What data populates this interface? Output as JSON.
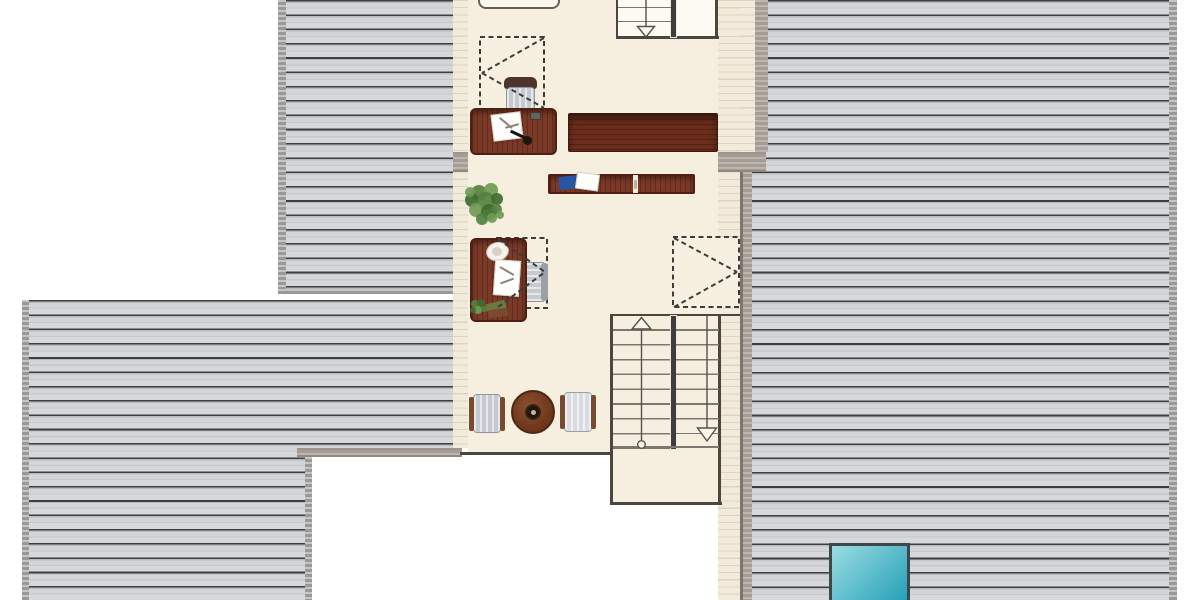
{
  "meta": {
    "type": "architectural-floor-plan-attic-level",
    "visible_text": "none"
  },
  "canvas": {
    "w": 1200,
    "h": 600,
    "bg": "#ffffff"
  },
  "palette": {
    "roof_line": "#3e3e3e",
    "roof_base": "#d3d5d6",
    "roof_edge": "#a6a6a6",
    "eave_base": "#f2ebdb",
    "eave_line": "#ddd3bf",
    "wall": "#aea69e",
    "outline": "#4c463f",
    "stair_line": "#7d786f",
    "floor": "#f6eede",
    "wood_desk": "#7b3927",
    "wood_sideboard": "#6b2d1c",
    "chair_gray": "#c6cad0",
    "chair_back_brown": "#4e342a",
    "armrest_brown": "#7a4a30",
    "table_wood": "#8c5130",
    "plant_green": "#55813f",
    "notebook_blue": "#2a55a4",
    "skylight_glass_light": "#9adde2",
    "skylight_glass_dark": "#27a0b8",
    "skylight_frame": "#3d484c"
  },
  "areas": [
    {
      "name": "roof-top-left",
      "cls": "roof",
      "r": [
        278,
        0,
        175,
        293
      ]
    },
    {
      "name": "roof-top-left-edge-left",
      "cls": "roof-edge",
      "r": [
        278,
        0,
        8,
        293
      ]
    },
    {
      "name": "roof-top-left-edge-bottom",
      "cls": "roof-edge",
      "r": [
        278,
        288.5,
        175,
        5
      ]
    },
    {
      "name": "roof-bottom-left",
      "cls": "roof",
      "r": [
        22,
        300,
        431,
        300
      ]
    },
    {
      "name": "roof-bottom-left-edge-left",
      "cls": "roof-edge",
      "r": [
        22,
        300,
        7,
        300
      ]
    },
    {
      "name": "void-bottom-left",
      "cls": "white",
      "r": [
        312,
        457,
        141,
        143
      ]
    },
    {
      "name": "roof-bottom-left-edge-right",
      "cls": "roof-edge",
      "r": [
        305,
        457,
        7,
        143
      ]
    },
    {
      "name": "roof-right",
      "cls": "roof",
      "r": [
        752,
        0,
        417,
        600
      ]
    },
    {
      "name": "roof-right-edge-right",
      "cls": "roof-edge",
      "r": [
        1169,
        0,
        8,
        600
      ]
    },
    {
      "name": "eave-strip-left",
      "cls": "eave",
      "r": [
        453,
        0,
        15,
        448
      ]
    },
    {
      "name": "eave-strip-left-top",
      "cls": "eave",
      "r": [
        453,
        0,
        30,
        37
      ]
    },
    {
      "name": "eave-strip-right",
      "cls": "eave",
      "r": [
        718,
        0,
        22,
        600
      ]
    },
    {
      "name": "eave-strip-right-upper",
      "cls": "eave",
      "r": [
        740,
        0,
        15,
        152
      ]
    },
    {
      "name": "wall-upper-right",
      "cls": "wall",
      "r": [
        755,
        0,
        13,
        152
      ]
    },
    {
      "name": "wall-right",
      "cls": "wall wall-left-edge",
      "r": [
        740,
        172,
        12,
        428
      ]
    },
    {
      "name": "wall-mid-horizontal",
      "cls": "wall wall-h",
      "r": [
        453,
        152,
        313,
        20
      ]
    },
    {
      "name": "wall-bottom-horizontal",
      "cls": "wall wall-h",
      "r": [
        297,
        448,
        165,
        9
      ]
    },
    {
      "name": "floor-main-room",
      "cls": "floor",
      "r": [
        468,
        0,
        250,
        453
      ]
    },
    {
      "name": "floor-stairwell-extension",
      "cls": "floor",
      "r": [
        612,
        448,
        108,
        55
      ]
    },
    {
      "name": "floor-upper-stairs",
      "cls": "floor-light",
      "r": [
        617,
        0,
        99,
        38
      ]
    },
    {
      "name": "room-bottom-wall-line",
      "cls": "ln",
      "r": [
        460,
        451.5,
        153,
        3
      ]
    },
    {
      "name": "stairwell-left-wall-line",
      "cls": "ln",
      "r": [
        610,
        313.5,
        3,
        191
      ]
    },
    {
      "name": "stairwell-bottom-wall-line",
      "cls": "ln",
      "r": [
        610,
        501.5,
        112,
        3
      ]
    },
    {
      "name": "stairwell-right-wall-line",
      "cls": "ln",
      "r": [
        718,
        313.5,
        3,
        191
      ]
    },
    {
      "name": "stairwell-top-line",
      "cls": "ln",
      "r": [
        610,
        313.5,
        130,
        2.5
      ]
    },
    {
      "name": "upper-stairs-left-line",
      "cls": "ln",
      "r": [
        615.5,
        0,
        2.5,
        38
      ]
    },
    {
      "name": "upper-stairs-bottom-line",
      "cls": "ln",
      "r": [
        615.5,
        36,
        103,
        3
      ]
    },
    {
      "name": "upper-stairs-right-line",
      "cls": "ln",
      "r": [
        715,
        0,
        3,
        38
      ]
    },
    {
      "name": "upper-stairs-divider",
      "cls": "divider",
      "r": [
        671,
        0,
        5,
        36.5
      ]
    },
    {
      "name": "main-stairs-divider",
      "cls": "divider",
      "r": [
        670.5,
        316,
        5,
        133
      ]
    },
    {
      "name": "main-stairs-treads-left-flight",
      "cls": "treads",
      "r": [
        613,
        316,
        57,
        133
      ]
    },
    {
      "name": "main-stairs-treads-right-flight",
      "cls": "treads",
      "r": [
        676,
        316,
        43,
        118
      ]
    },
    {
      "name": "main-stairs-landing-line",
      "cls": "stair-line",
      "r": [
        613,
        446,
        106,
        1.6
      ]
    },
    {
      "name": "upper-stairs-tread-1",
      "cls": "stair-line",
      "r": [
        618,
        6.5,
        53,
        1.6
      ]
    },
    {
      "name": "upper-stairs-tread-2",
      "cls": "stair-line",
      "r": [
        618,
        20.5,
        53,
        1.6
      ]
    }
  ],
  "svg_under": [
    {
      "k": "drect",
      "name": "roof-window-1",
      "r": [
        480,
        37,
        64,
        72
      ]
    },
    {
      "k": "drect",
      "name": "roof-window-2",
      "r": [
        673,
        237,
        66,
        70
      ]
    },
    {
      "k": "drect",
      "name": "roof-window-3",
      "r": [
        497,
        238,
        50,
        70
      ]
    }
  ],
  "furniture": [
    {
      "name": "desk-chair-1-backrest",
      "cls": "wood-dark",
      "r": [
        504,
        77,
        33,
        12
      ],
      "br": "6px 6px 3px 3px"
    },
    {
      "name": "desk-chair-1-seat",
      "cls": "chair-seat",
      "r": [
        506,
        87,
        29,
        25
      ]
    },
    {
      "name": "cabinet-top-edge",
      "cls": "cream-box",
      "r": [
        478,
        -9,
        82,
        18
      ],
      "br": "8px",
      "bd": "2px solid #675f55"
    },
    {
      "name": "desk-1",
      "cls": "wood",
      "r": [
        470,
        108,
        87,
        47
      ],
      "br": "6px"
    },
    {
      "name": "desk-1-open-book",
      "cls": "paper",
      "r": [
        492,
        113,
        30,
        27
      ],
      "rot": -7
    },
    {
      "name": "desk-1-book-mark-1",
      "cls": "mark",
      "r": [
        498,
        122,
        16,
        1.5
      ],
      "rot": 40
    },
    {
      "name": "desk-1-book-mark-2",
      "cls": "mark",
      "r": [
        505,
        125,
        14,
        1.5
      ],
      "rot": -15
    },
    {
      "name": "desk-1-pen",
      "r": [
        510,
        133,
        16,
        2.5
      ],
      "bg": "#141414",
      "rot": 25
    },
    {
      "name": "desk-1-round-object",
      "r": [
        523,
        136,
        9,
        9
      ],
      "bg": "#20150c",
      "br": "50%"
    },
    {
      "name": "desk-1-small-item",
      "r": [
        530,
        112,
        11,
        8
      ],
      "bg": "#64625c",
      "br": "2px",
      "bd": "1px solid #3a3a38"
    },
    {
      "name": "sideboard-long",
      "cls": "wood-h",
      "r": [
        568,
        113,
        150,
        39
      ],
      "br": "2px"
    },
    {
      "name": "cabinet-row",
      "cls": "wood",
      "r": [
        548,
        174,
        147,
        20
      ],
      "br": "2px"
    },
    {
      "name": "cabinet-row-slot",
      "r": [
        633,
        175,
        5,
        18
      ],
      "bg": "#efe9da"
    },
    {
      "name": "cabinet-row-handle",
      "r": [
        634,
        180,
        3,
        9
      ],
      "bg": "#b9b2a4",
      "br": "2px"
    },
    {
      "name": "cabinet-row-blue-notebook",
      "r": [
        559,
        176,
        21,
        13
      ],
      "bg": "#2a55a4",
      "rot": -6,
      "br": "1px"
    },
    {
      "name": "cabinet-row-paper",
      "cls": "paper",
      "r": [
        576,
        173,
        23,
        17
      ],
      "rot": 8
    },
    {
      "name": "desk-chair-2-seat",
      "cls": "chair-seat-h",
      "r": [
        519,
        262,
        27,
        40
      ]
    },
    {
      "name": "desk-chair-2-backrest",
      "r": [
        541,
        263,
        7,
        38
      ],
      "bg": "#9aa0a8",
      "br": "3px"
    },
    {
      "name": "desk-2",
      "cls": "wood",
      "r": [
        470,
        238,
        57,
        84
      ],
      "br": "6px"
    },
    {
      "name": "desk-2-white-object",
      "r": [
        486,
        242,
        23,
        19
      ],
      "bg": "#f6f3ea",
      "br": "50%",
      "bd": "1px solid #c9c2b4",
      "rot": -15
    },
    {
      "name": "desk-2-white-object-center",
      "r": [
        492,
        247,
        10,
        9
      ],
      "bg": "#d8d2c4",
      "br": "50%"
    },
    {
      "name": "desk-2-papers",
      "cls": "paper",
      "r": [
        494,
        260,
        26,
        36
      ],
      "rot": 4
    },
    {
      "name": "desk-2-paper-mark-1",
      "cls": "mark",
      "r": [
        499,
        270,
        16,
        1.5
      ],
      "rot": 30
    },
    {
      "name": "desk-2-paper-mark-2",
      "cls": "mark",
      "r": [
        500,
        280,
        14,
        1.5
      ],
      "rot": -20
    },
    {
      "name": "desk-2-book-green",
      "r": [
        486,
        302,
        20,
        8
      ],
      "bg": "#6b7a3c",
      "rot": -14,
      "br": "1px"
    },
    {
      "name": "desk-2-book-brown",
      "r": [
        488,
        309,
        20,
        8
      ],
      "bg": "#7b4a2e",
      "rot": -8,
      "br": "1px"
    },
    {
      "name": "round-table",
      "cls": "table-round",
      "r": [
        511,
        390,
        44,
        44
      ]
    },
    {
      "name": "round-table-hub",
      "r": [
        525,
        404,
        16,
        16
      ],
      "bg": "#20150e",
      "br": "50%",
      "bd": "2px solid #392216"
    },
    {
      "name": "round-table-center-dot",
      "r": [
        530.5,
        409.5,
        5,
        5
      ],
      "bg": "#cdb38c",
      "br": "50%"
    },
    {
      "name": "lounge-chair-left-seat",
      "cls": "chair-seat",
      "r": [
        473,
        394,
        28,
        39
      ]
    },
    {
      "name": "lounge-chair-left-armrest-a",
      "r": [
        469,
        397,
        5,
        34
      ],
      "bg": "#7a4a30",
      "br": "2px"
    },
    {
      "name": "lounge-chair-left-armrest-b",
      "r": [
        500,
        397,
        5,
        34
      ],
      "bg": "#7a4a30",
      "br": "2px"
    },
    {
      "name": "lounge-chair-right-seat",
      "cls": "chair-seat-light",
      "r": [
        564,
        392,
        28,
        40
      ]
    },
    {
      "name": "lounge-chair-right-armrest-a",
      "r": [
        560,
        395,
        5,
        34
      ],
      "bg": "#7a4a30",
      "br": "2px"
    },
    {
      "name": "lounge-chair-right-armrest-b",
      "r": [
        591,
        395,
        5,
        34
      ],
      "bg": "#7a4a30",
      "br": "2px"
    },
    {
      "name": "roof-skylight-glass",
      "cls": "glass",
      "r": [
        829,
        543,
        81,
        60
      ]
    }
  ],
  "svg_over": [
    {
      "k": "dline",
      "name": "roof-window-1-projection-a",
      "p": [
        544,
        38,
        482,
        73
      ]
    },
    {
      "k": "dline",
      "name": "roof-window-1-projection-b",
      "p": [
        482,
        73,
        544,
        108
      ]
    },
    {
      "k": "dline",
      "name": "roof-window-2-projection-a",
      "p": [
        674,
        238,
        737,
        272
      ]
    },
    {
      "k": "dline",
      "name": "roof-window-2-projection-b",
      "p": [
        674,
        307,
        737,
        272
      ]
    },
    {
      "k": "dline",
      "name": "roof-window-3-projection-a",
      "p": [
        498,
        239,
        545,
        272
      ]
    },
    {
      "k": "dline",
      "name": "roof-window-3-projection-b",
      "p": [
        498,
        307,
        545,
        272
      ]
    },
    {
      "k": "line",
      "name": "upper-stair-direction-line",
      "p": [
        646,
        0,
        646,
        26.5
      ]
    },
    {
      "k": "tri",
      "name": "upper-stair-arrow-down",
      "pts": [
        [
          637.5,
          26.5
        ],
        [
          654.5,
          26.5
        ],
        [
          646,
          37
        ]
      ]
    },
    {
      "k": "tri",
      "name": "main-stair-arrow-up",
      "pts": [
        [
          632,
          329
        ],
        [
          651,
          329
        ],
        [
          641.5,
          317.5
        ]
      ]
    },
    {
      "k": "line",
      "name": "main-stair-direction-line-left",
      "p": [
        641.5,
        329,
        641.5,
        440
      ]
    },
    {
      "k": "circle",
      "name": "main-stair-direction-start",
      "c": [
        641.5,
        444.5,
        3.8
      ]
    },
    {
      "k": "line",
      "name": "main-stair-direction-line-right",
      "p": [
        707,
        316,
        707,
        428
      ]
    },
    {
      "k": "tri",
      "name": "main-stair-arrow-down",
      "pts": [
        [
          697.5,
          428
        ],
        [
          716.5,
          428
        ],
        [
          707,
          441
        ]
      ]
    },
    {
      "k": "blobs",
      "name": "potted-plant-large",
      "dots": [
        [
          479,
          193,
          8,
          "#55813f"
        ],
        [
          491,
          190,
          7,
          "#6f9b52"
        ],
        [
          472,
          200,
          7,
          "#3f6b2e"
        ],
        [
          486,
          201,
          9,
          "#55813f"
        ],
        [
          497,
          199,
          6,
          "#3f6b2e"
        ],
        [
          476,
          210,
          7,
          "#6f9b52"
        ],
        [
          489,
          212,
          8,
          "#3f6b2e"
        ],
        [
          497,
          209,
          5,
          "#55813f"
        ],
        [
          482,
          219,
          6,
          "#55813f"
        ],
        [
          492,
          218,
          5,
          "#6f9b52"
        ],
        [
          470,
          192,
          5,
          "#6f9b52"
        ],
        [
          500,
          215,
          4,
          "#6f9b52"
        ]
      ]
    },
    {
      "k": "blobs",
      "name": "desk-plant-small",
      "dots": [
        [
          475,
          304,
          4,
          "#55813f"
        ],
        [
          481,
          303,
          4,
          "#3f6b2e"
        ],
        [
          478,
          310,
          4,
          "#6f9b52"
        ],
        [
          484,
          309,
          3,
          "#55813f"
        ],
        [
          473,
          310,
          3,
          "#3f6b2e"
        ]
      ]
    }
  ]
}
